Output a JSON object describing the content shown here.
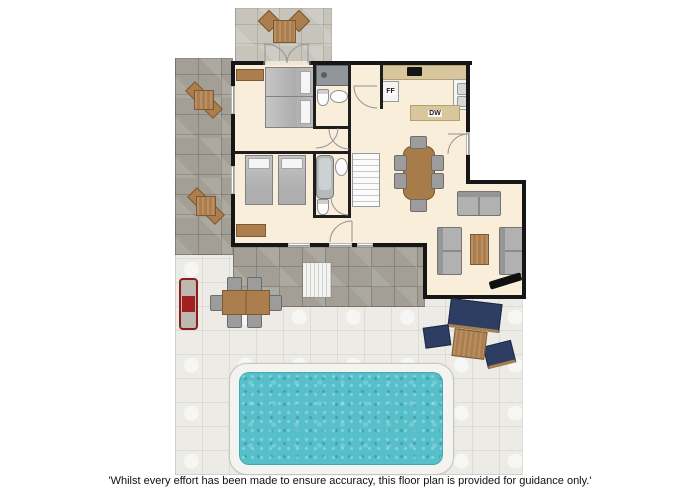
{
  "disclaimer": "'Whilst every effort has been made to ensure accuracy, this floor plan is provided for guidance only.'",
  "kitchen": {
    "fridge_freezer_label": "FF",
    "dishwasher_label": "DW"
  },
  "colors": {
    "wall": "#161616",
    "floor": "#f8eed9",
    "kitchen_counter": "#d8c69c",
    "pool_water": "#57bfca",
    "pool_surround": "#f4f3ef",
    "deck_stone": "#ecebe6",
    "patio_stone_dark": "#a39f96",
    "patio_stone_top": "#c7c4bc",
    "wood": "#ac7e4d",
    "outdoor_cushion_navy": "#2e3e62",
    "bbq_red": "#8c1d1d",
    "sofa_gray": "#b1b1b1"
  }
}
